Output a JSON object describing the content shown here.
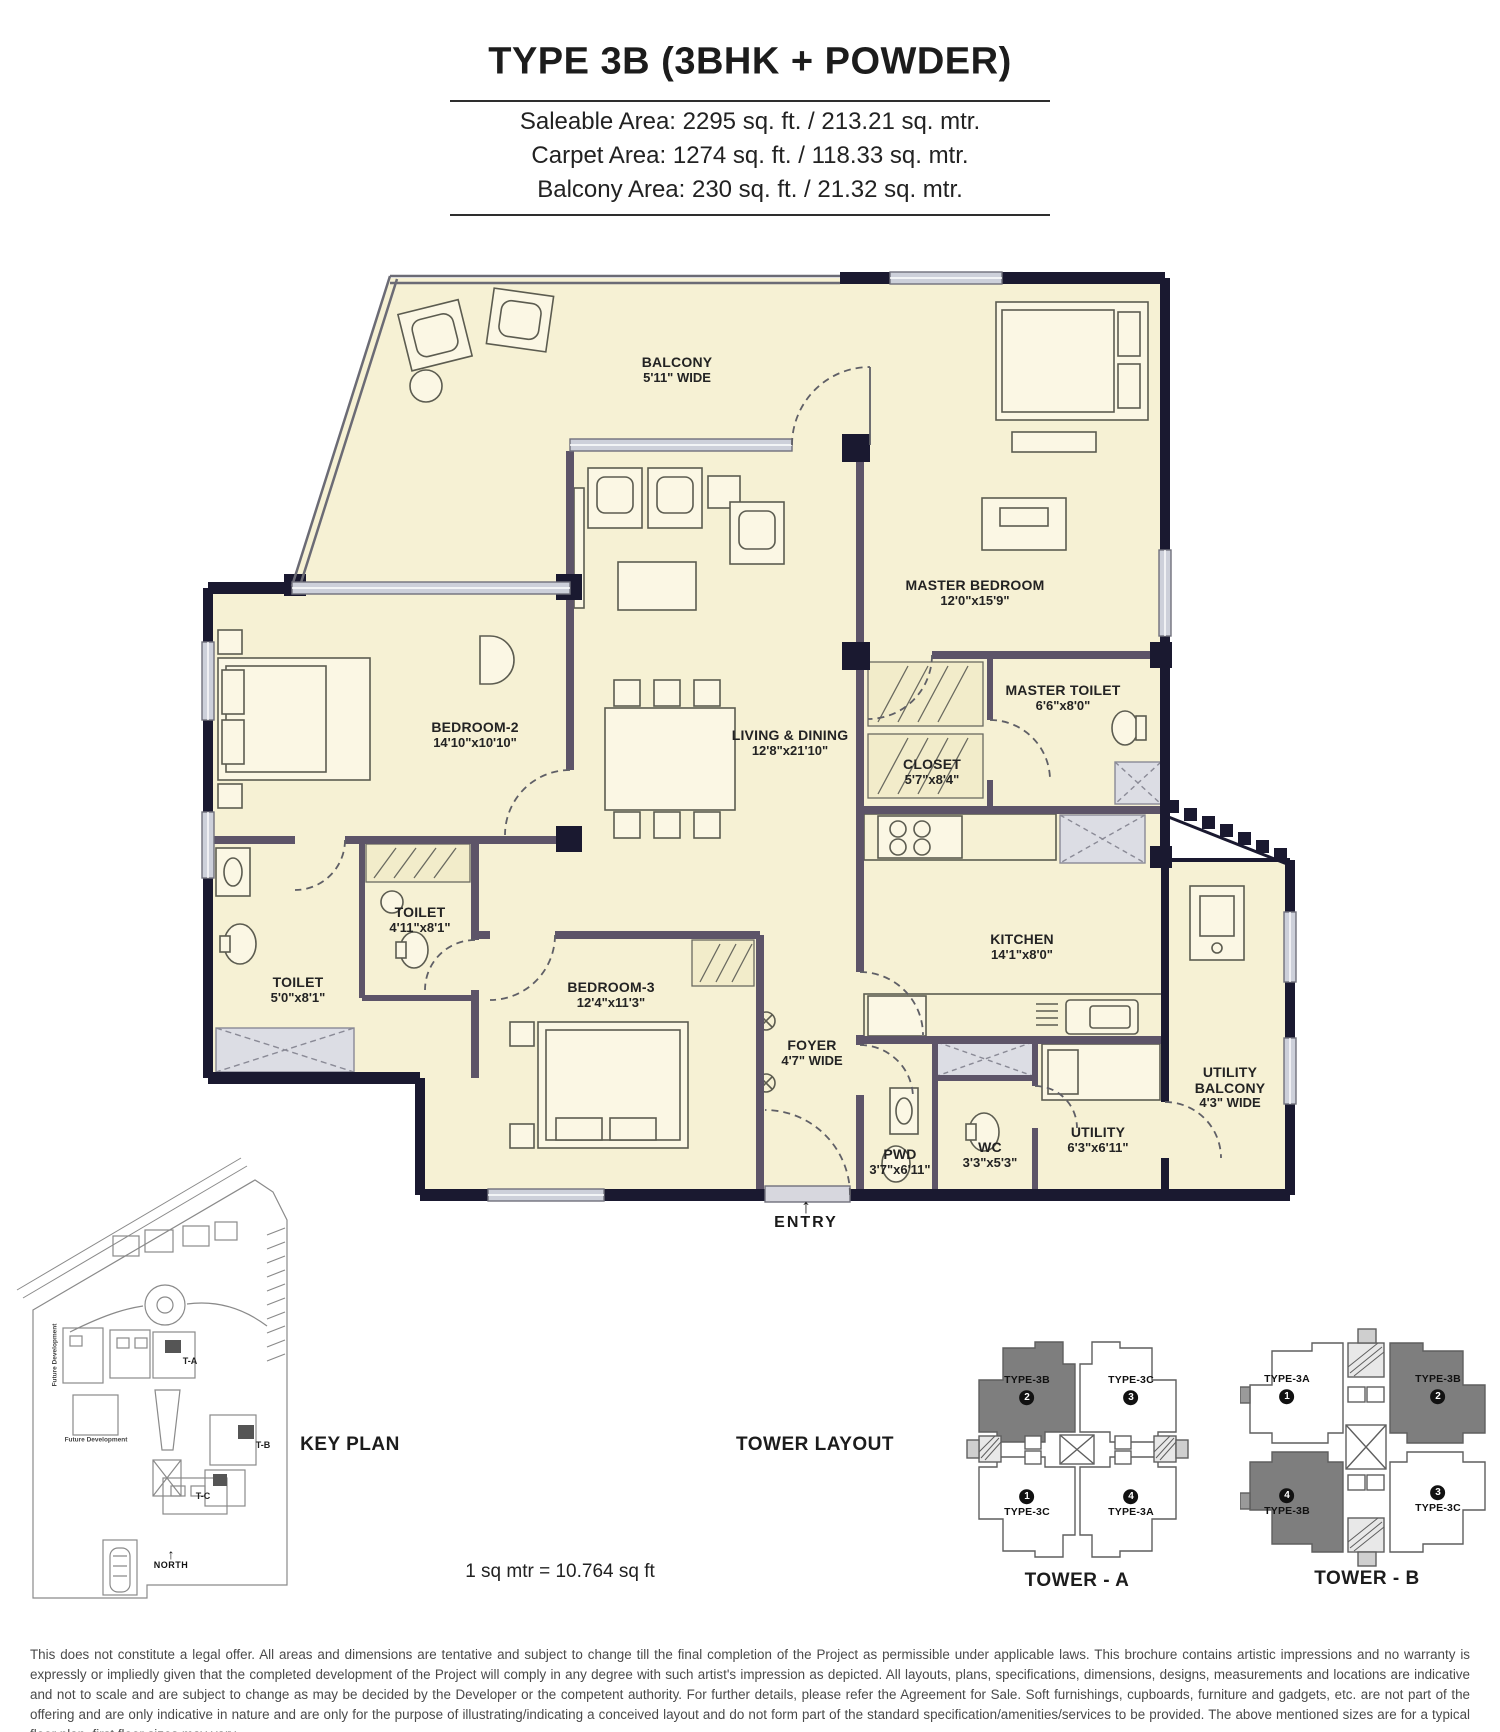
{
  "header": {
    "title": "TYPE 3B (3BHK + POWDER)",
    "areas": [
      "Saleable Area: 2295 sq. ft. / 213.21 sq. mtr.",
      "Carpet Area: 1274 sq. ft. / 118.33 sq. mtr.",
      "Balcony Area: 230 sq. ft. / 21.32 sq. mtr."
    ]
  },
  "floor_plan": {
    "rooms": [
      {
        "name": "BALCONY",
        "dims": "5'11\" WIDE"
      },
      {
        "name": "MASTER BEDROOM",
        "dims": "12'0\"x15'9\""
      },
      {
        "name": "BEDROOM-2",
        "dims": "14'10\"x10'10\""
      },
      {
        "name": "LIVING & DINING",
        "dims": "12'8\"x21'10\""
      },
      {
        "name": "MASTER TOILET",
        "dims": "6'6\"x8'0\""
      },
      {
        "name": "CLOSET",
        "dims": "5'7\"x8'4\""
      },
      {
        "name": "KITCHEN",
        "dims": "14'1\"x8'0\""
      },
      {
        "name": "TOILET",
        "dims": "4'11\"x8'1\""
      },
      {
        "name": "TOILET",
        "dims": "5'0\"x8'1\""
      },
      {
        "name": "BEDROOM-3",
        "dims": "12'4\"x11'3\""
      },
      {
        "name": "FOYER",
        "dims": "4'7\" WIDE"
      },
      {
        "name": "PWD",
        "dims": "3'7\"x6'11\""
      },
      {
        "name": "WC",
        "dims": "3'3\"x5'3\""
      },
      {
        "name": "UTILITY",
        "dims": "6'3\"x6'11\""
      },
      {
        "name": "UTILITY BALCONY",
        "dims": "4'3\" WIDE"
      }
    ],
    "entry_label": "ENTRY",
    "entry_arrow": "↑"
  },
  "key_plan": {
    "heading": "KEY PLAN",
    "tower_a": "T-A",
    "tower_b": "T-B",
    "tower_c": "T-C",
    "north": "NORTH",
    "north_arrow": "↑",
    "future_development": "Future Development"
  },
  "tower_layout": {
    "heading": "TOWER LAYOUT",
    "towers": [
      {
        "caption": "TOWER - A",
        "units": [
          {
            "type": "TYPE-3B",
            "num": "2",
            "shaded": true
          },
          {
            "type": "TYPE-3C",
            "num": "3",
            "shaded": false
          },
          {
            "type": "TYPE-3C",
            "num": "1",
            "shaded": false
          },
          {
            "type": "TYPE-3A",
            "num": "4",
            "shaded": false
          }
        ]
      },
      {
        "caption": "TOWER - B",
        "units": [
          {
            "type": "TYPE-3A",
            "num": "1",
            "shaded": false
          },
          {
            "type": "TYPE-3B",
            "num": "2",
            "shaded": true
          },
          {
            "type": "TYPE-3B",
            "num": "4",
            "shaded": true
          },
          {
            "type": "TYPE-3C",
            "num": "3",
            "shaded": false
          }
        ]
      }
    ]
  },
  "footer": {
    "scale_note": "1 sq mtr = 10.764 sq ft",
    "disclaimer": "This does not constitute a legal offer. All areas and dimensions are tentative and subject to change till the final completion of the Project as permissible under applicable laws. This brochure contains artistic impressions and no warranty is expressly or impliedly given that the completed development of the Project will comply in any degree with such artist's impression as depicted. All layouts, plans, specifications, dimensions, designs, measurements and locations are indicative and not to scale and are subject to change as may be decided by the Developer or the competent authority. For further details, please refer the Agreement for Sale. Soft furnishings, cupboards, furniture and gadgets, etc. are not part of the offering and are only indicative in nature and are only for the purpose of illustrating/indicating a conceived layout and do not form part of the standard specification/amenities/services to be provided. The above mentioned sizes are for a typical floor plan, first floor sizes may vary."
  },
  "colors": {
    "room_fill": "#f6f1d4",
    "exterior_wall": "#1a1930",
    "interior_wall": "#5d5468",
    "shaded_unit": "#7e7e7e",
    "window_gray": "#cdd0da"
  }
}
